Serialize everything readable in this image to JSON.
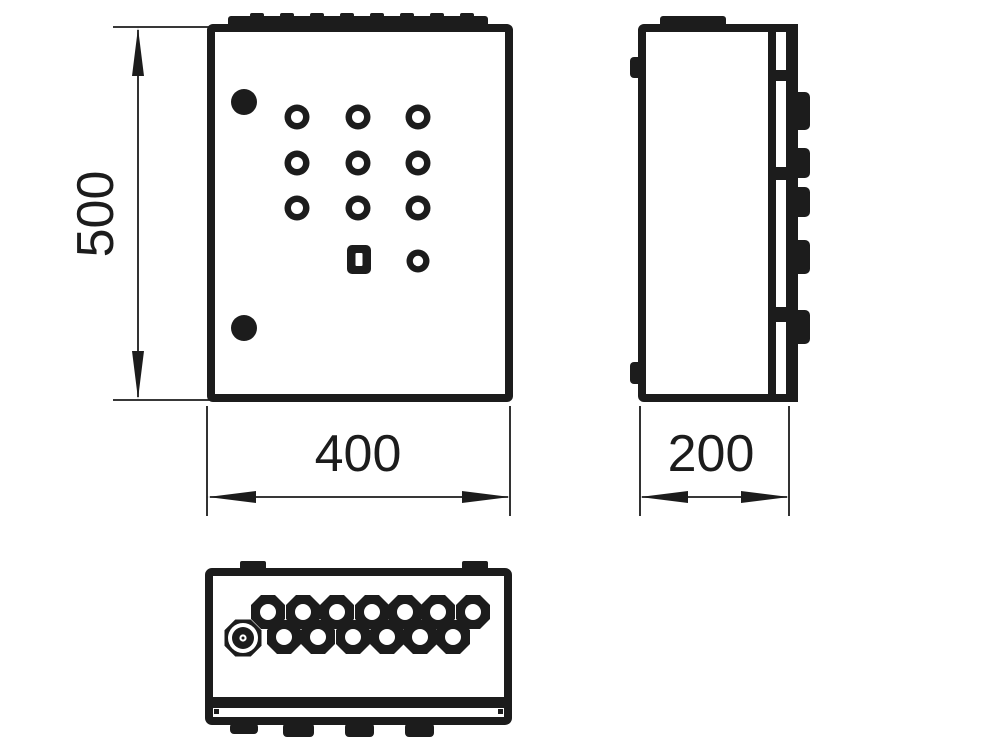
{
  "drawing": {
    "kind": "technical-drawing",
    "subject": "wall-mounted electrical enclosure, three orthographic views",
    "dimensions": {
      "height": "500",
      "width": "400",
      "depth": "200"
    },
    "colors": {
      "ink": "#1c1c1c",
      "background": "#ffffff"
    }
  }
}
